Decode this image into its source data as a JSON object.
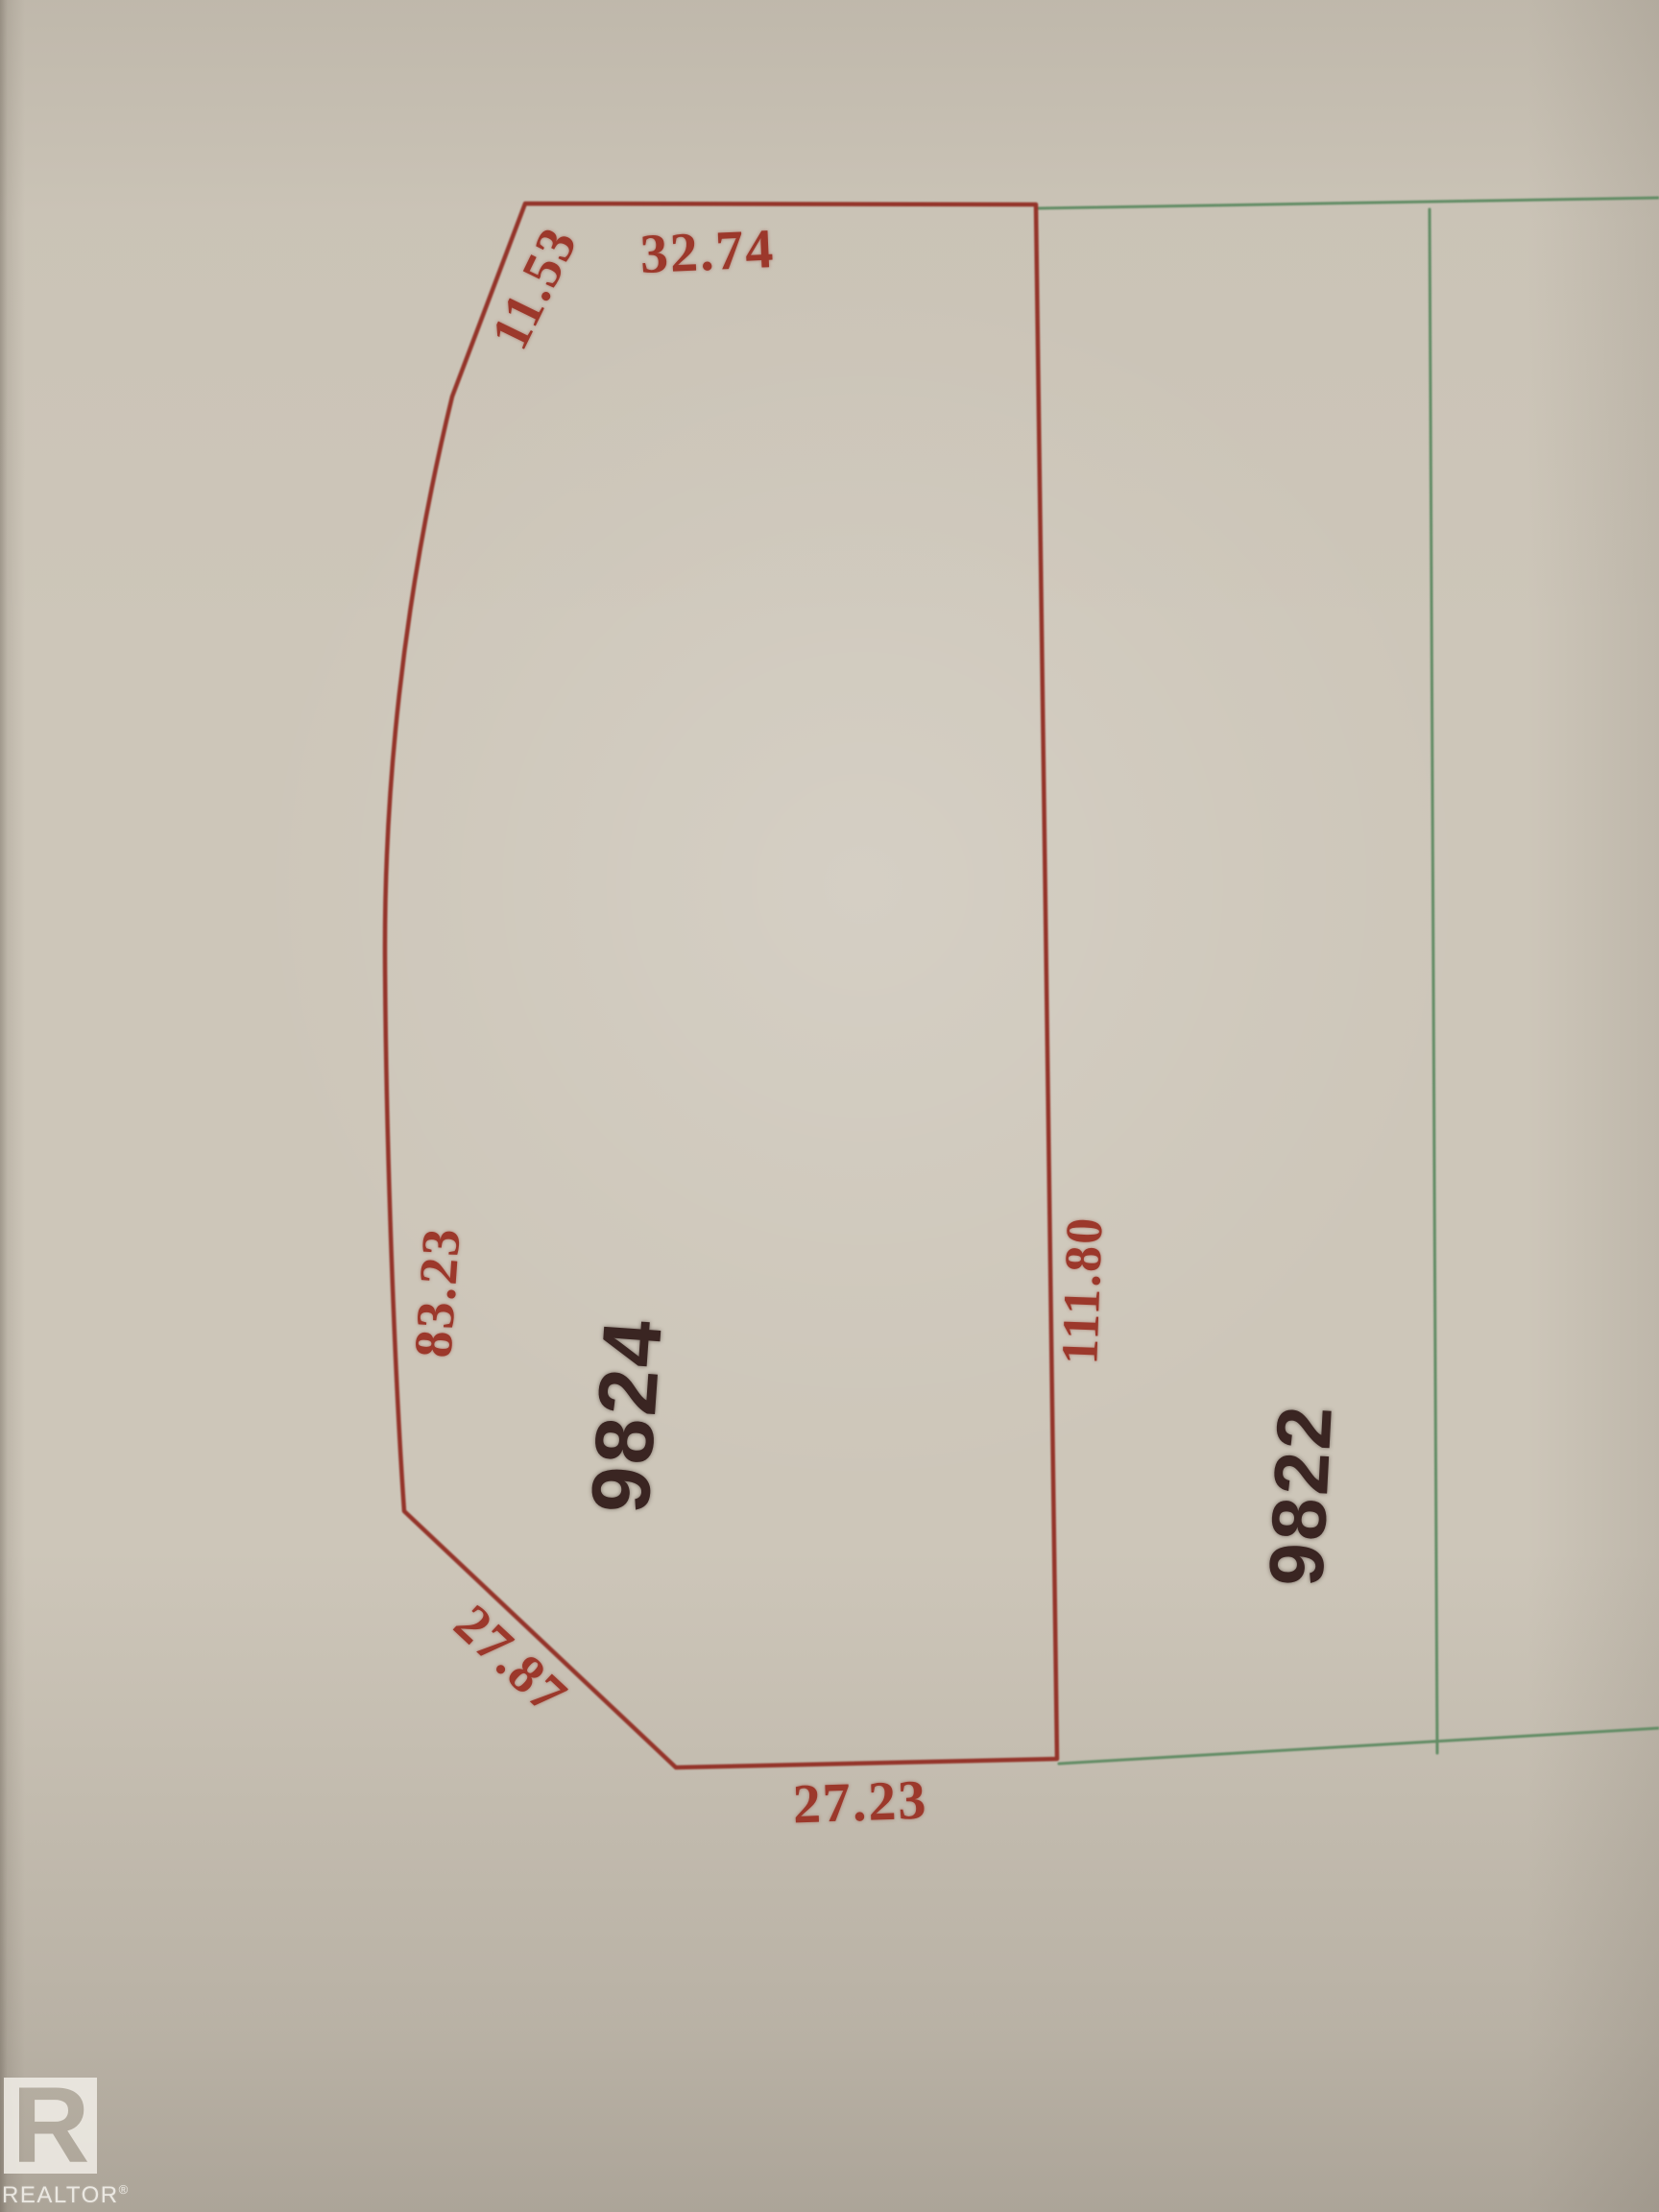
{
  "watermark": {
    "label": "REALTOR",
    "registered_symbol": "®",
    "logo_letter": "R"
  },
  "lots": {
    "main": {
      "number": "9824",
      "dims": {
        "top": "32.74",
        "upper_left": "11.53",
        "left": "83.23",
        "lower_left": "27.87",
        "bottom": "27.23",
        "right": "111.80"
      }
    },
    "adjacent": {
      "number": "9822"
    }
  },
  "colors": {
    "main_boundary": "#94342a",
    "dimension_text": "#9c382b",
    "adjacent_boundary": "#628c65",
    "lot_number_text": "#3a2522",
    "paper": "#cdc6b9"
  }
}
